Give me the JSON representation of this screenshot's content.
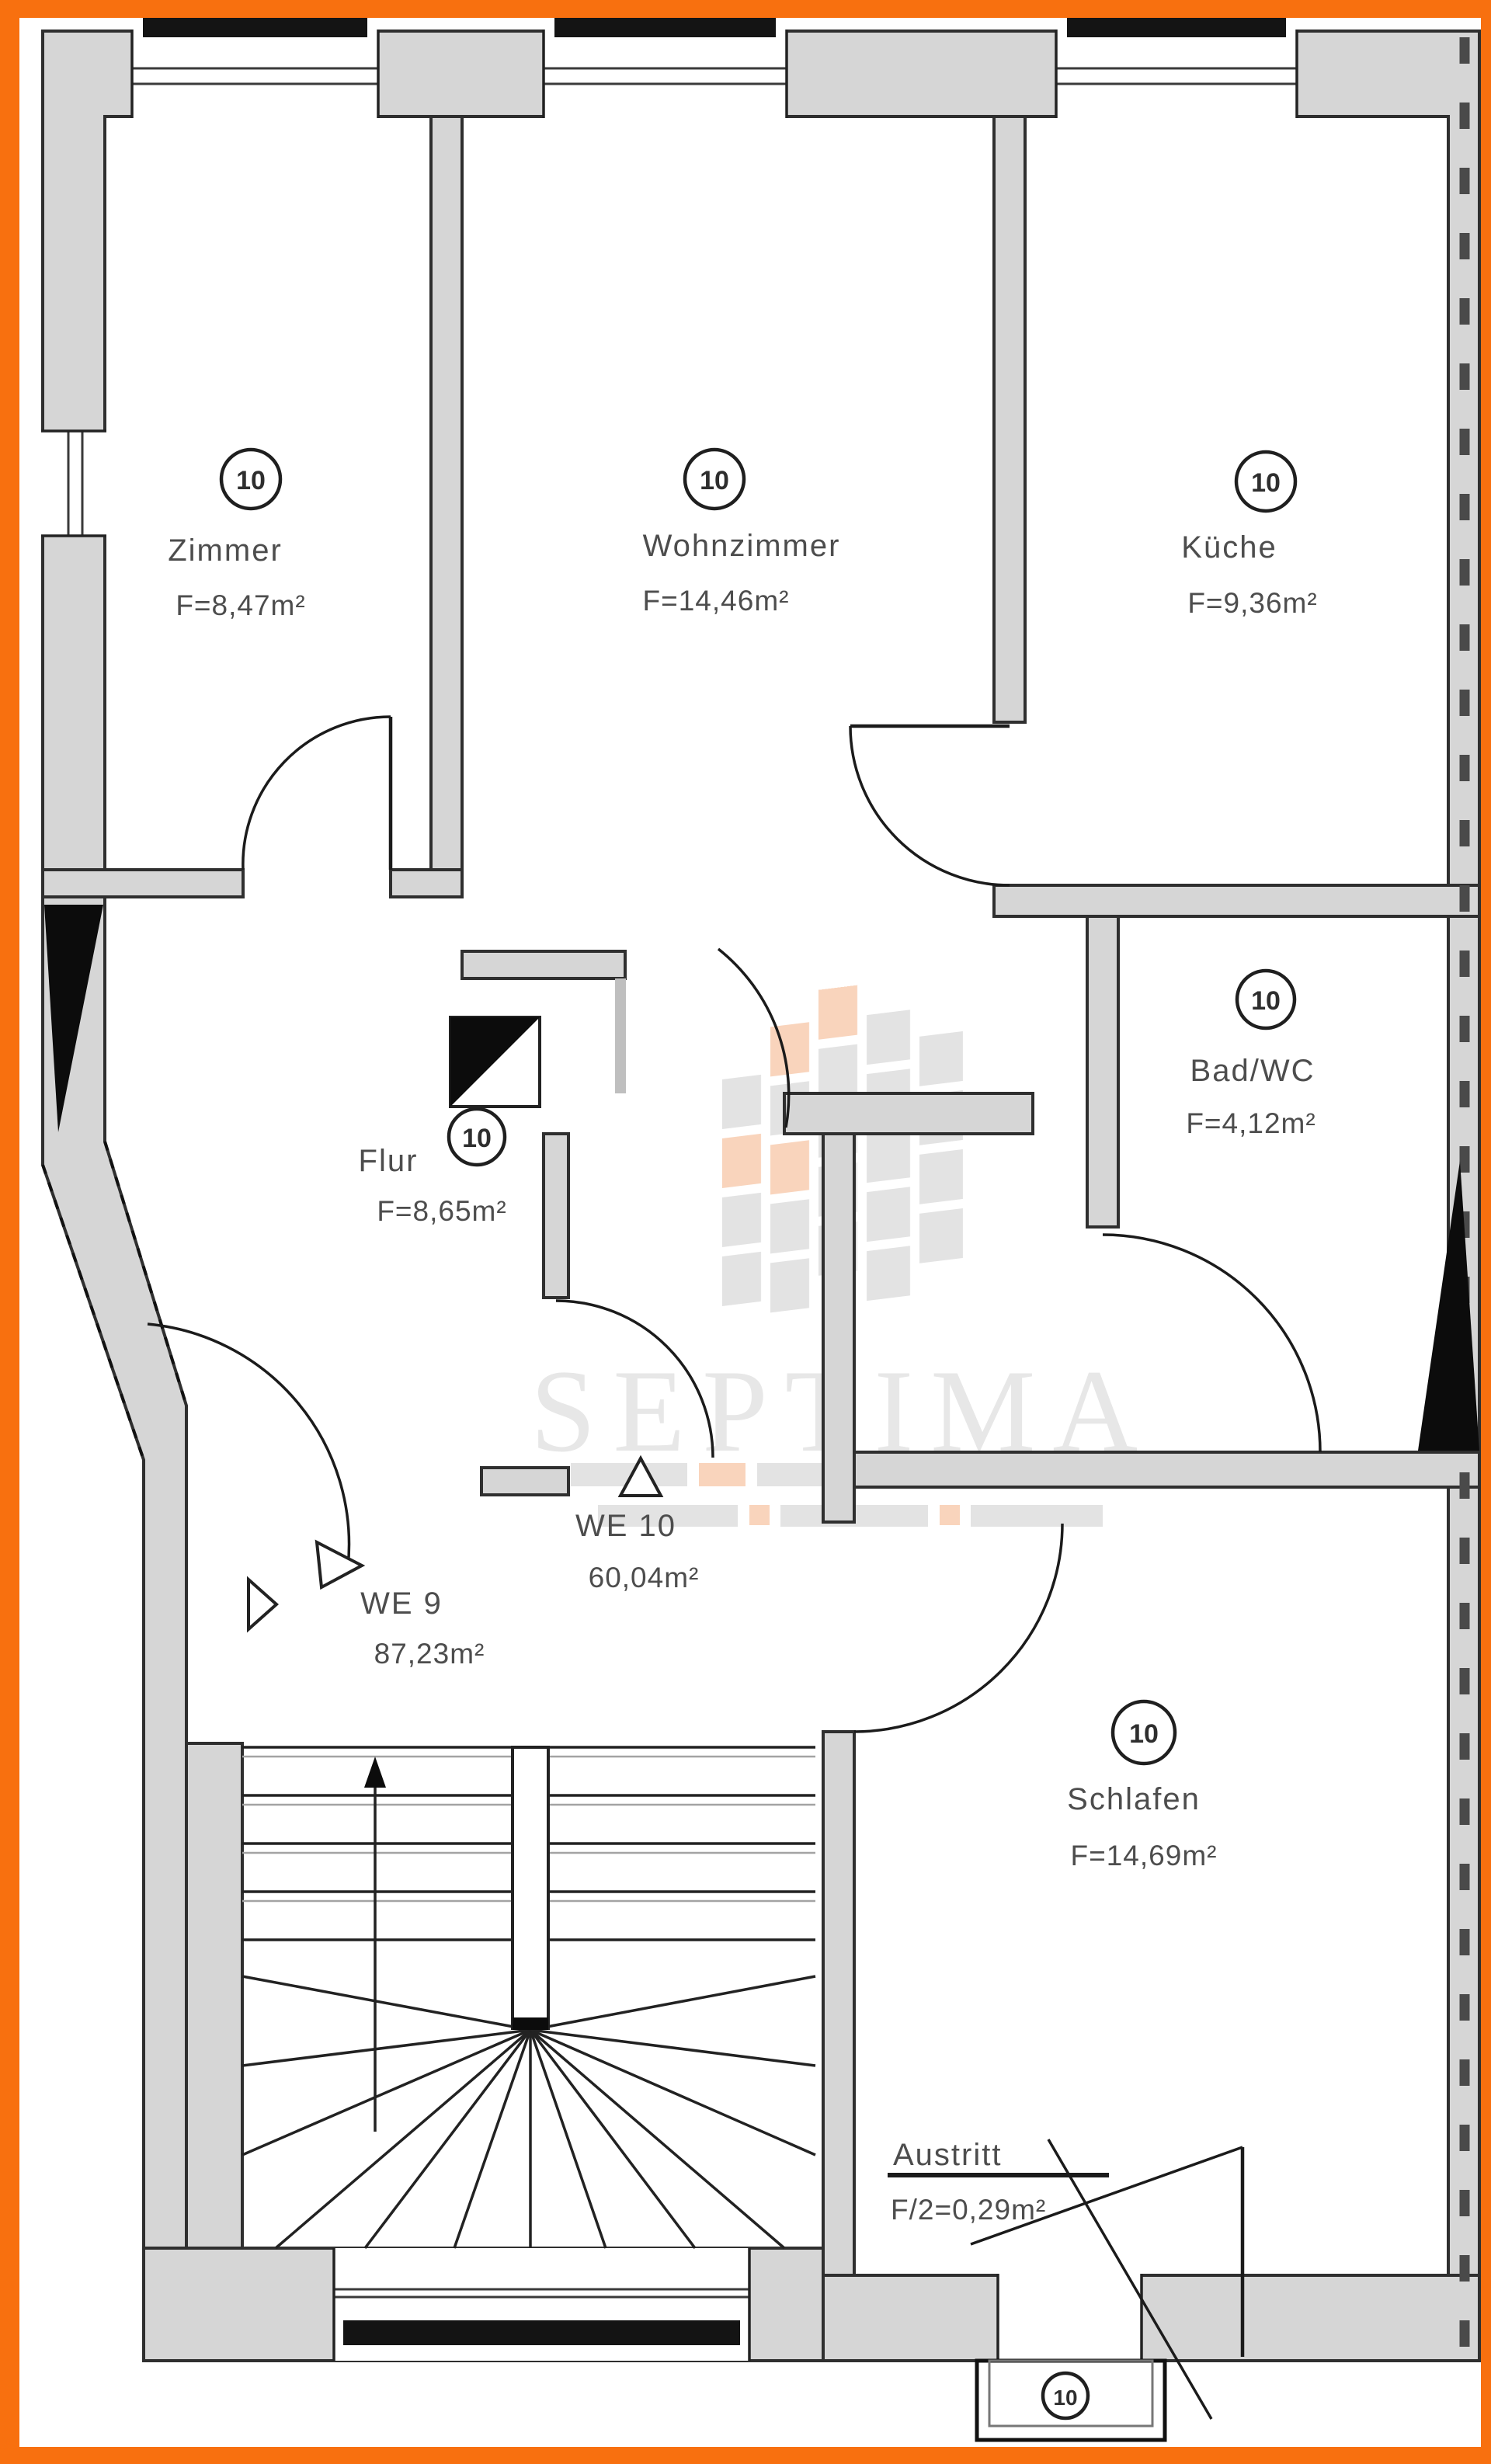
{
  "document_type": "apartment-floor-plan",
  "watermark": {
    "brand": "SEPTIMA"
  },
  "rooms": [
    {
      "id": "zimmer",
      "name": "Zimmer",
      "area": "F=8,47m²",
      "unit": "10"
    },
    {
      "id": "wohnzimmer",
      "name": "Wohnzimmer",
      "area": "F=14,46m²",
      "unit": "10"
    },
    {
      "id": "kueche",
      "name": "Küche",
      "area": "F=9,36m²",
      "unit": "10"
    },
    {
      "id": "bad-wc",
      "name": "Bad/WC",
      "area": "F=4,12m²",
      "unit": "10"
    },
    {
      "id": "flur",
      "name": "Flur",
      "area": "F=8,65m²",
      "unit": "10"
    },
    {
      "id": "schlafen",
      "name": "Schlafen",
      "area": "F=14,69m²",
      "unit": "10"
    }
  ],
  "apartments": [
    {
      "label": "WE 10",
      "area": "60,04m²"
    },
    {
      "label": "WE 9",
      "area": "87,23m²"
    }
  ],
  "exit": {
    "label": "Austritt",
    "area": "F/2=0,29m²",
    "unit": "10"
  },
  "colors": {
    "frame": "#F8700F",
    "wall_fill": "#D6D6D6",
    "outline": "#2F2F2F",
    "label_text": "#4D4D4D",
    "watermark_gray": "#C6C6C6",
    "watermark_orange": "#F09A60"
  }
}
